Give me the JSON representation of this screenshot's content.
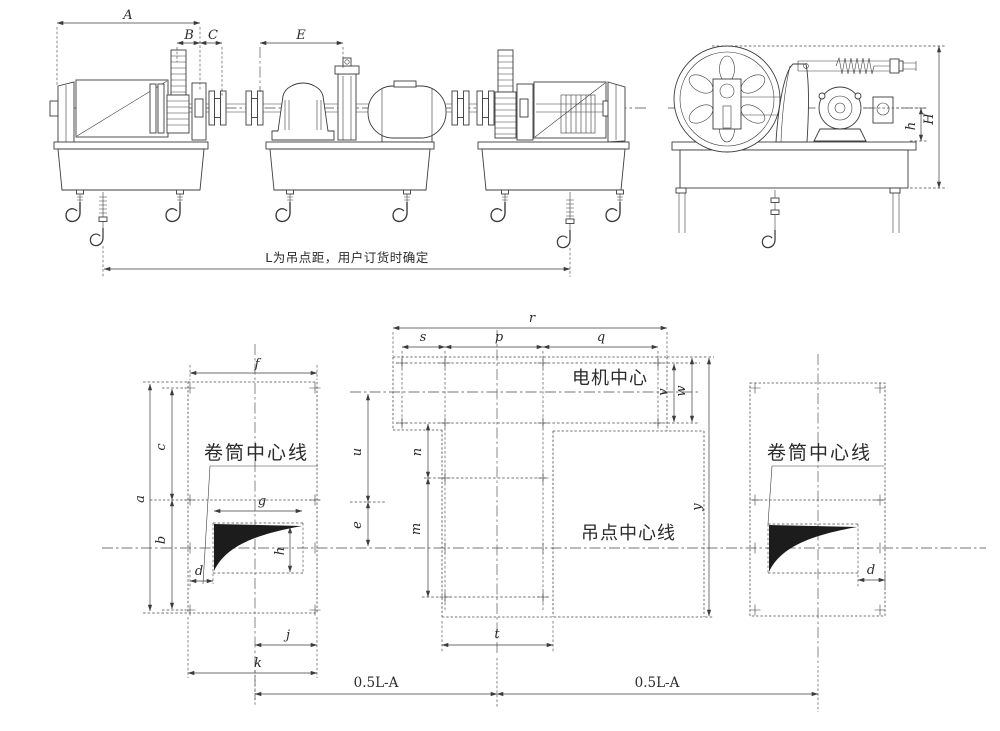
{
  "annotations": {
    "hang_distance_note": "L为吊点距，用户订货时确定",
    "drum_centerline_left": "卷筒中心线",
    "drum_centerline_right": "卷筒中心线",
    "motor_center": "电机中心",
    "hang_point_centerline": "吊点中心线",
    "half_span_left": "0.5L-A",
    "half_span_right": "0.5L-A"
  },
  "dimensions": {
    "front_view": {
      "A": "A",
      "B": "B",
      "C": "C",
      "E": "E"
    },
    "end_view": {
      "h": "h",
      "H": "H"
    },
    "plan_left": {
      "f": "f",
      "a": "a",
      "c": "c",
      "b": "b",
      "g": "g",
      "h": "h",
      "d": "d",
      "j": "j",
      "k": "k"
    },
    "plan_center": {
      "r": "r",
      "s": "s",
      "p": "p",
      "q": "q",
      "u": "u",
      "e": "e",
      "n": "n",
      "m": "m",
      "t": "t",
      "v": "v",
      "w": "w",
      "y": "y"
    },
    "plan_right": {
      "d": "d"
    }
  }
}
